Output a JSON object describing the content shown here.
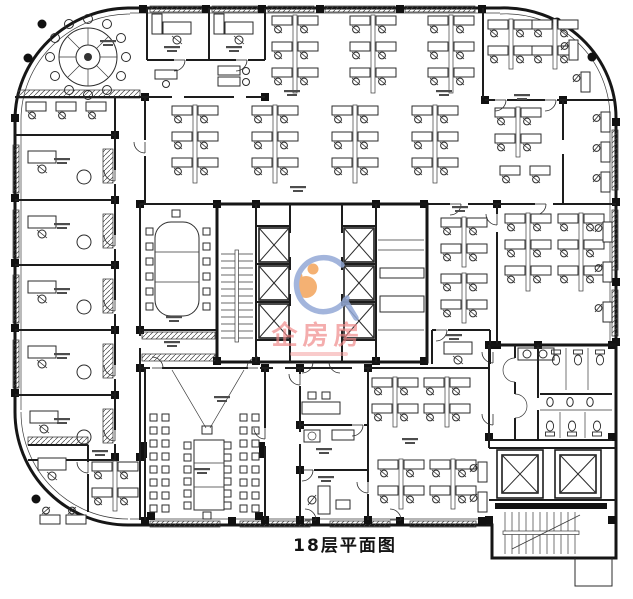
{
  "drawing": {
    "title": "18层平面图"
  },
  "watermark": {
    "text": "企房房"
  },
  "colors": {
    "background": "#ffffff",
    "line": "#2b2b2b",
    "wall": "#161616",
    "watermark_text": "#ef8888",
    "watermark_subtext": "#f2a0a0",
    "watermark_figure": "#f3a45b",
    "watermark_swoosh": "#93a9d6"
  },
  "icons": [
    {
      "name": "elevator-shaft-icon",
      "glyph": "crossed-box"
    },
    {
      "name": "stairs-icon",
      "glyph": "tread-lines"
    },
    {
      "name": "door-icon",
      "glyph": "quarter-arc"
    },
    {
      "name": "workstation-icon",
      "glyph": "desk-with-chair"
    },
    {
      "name": "round-conference-table-icon",
      "glyph": "circle-with-chairs"
    },
    {
      "name": "toilet-icon",
      "glyph": "bowl"
    }
  ]
}
